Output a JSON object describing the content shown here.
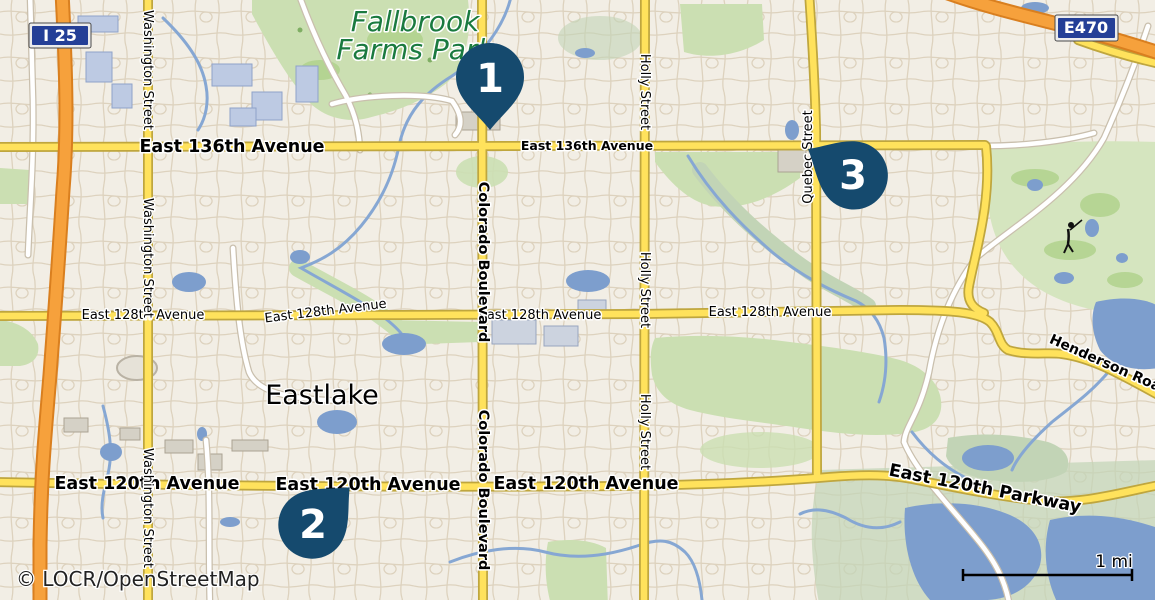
{
  "colors": {
    "bg": "#f2eee5",
    "marker": "#154a6e",
    "shield_blue": "#243f97",
    "road_yellow": "#ffe25c",
    "road_yellow_casing": "#bfa63e",
    "motorway": "#f6a13c",
    "motorway_casing": "#d97f1f",
    "white_road_casing": "#c9bfad",
    "water": "#7d9ecd",
    "stream": "#86a7d3",
    "park_green": "#cbdfb2",
    "golf_green": "#d5e5bf",
    "fairway": "#b0d28c",
    "wetland": "#c2d4b6",
    "label": "#000000",
    "park_label": "#1a7a3f",
    "halo": "#ffffff"
  },
  "shields": {
    "i25": "I 25",
    "e470": "E470"
  },
  "markers": [
    {
      "label": "1"
    },
    {
      "label": "2"
    },
    {
      "label": "3"
    }
  ],
  "labels": {
    "park_line1": "Fallbrook",
    "park_line2": "Farms Park",
    "town": "Eastlake",
    "e136_left": "East 136th Avenue",
    "e136_mid": "East 136th Avenue",
    "e128_a": "East 128th Avenue",
    "e128_b": "East 128th Avenue",
    "e128_c": "East 128th Avenue",
    "e128_d": "East 128th Avenue",
    "e120_a": "East 120th Avenue",
    "e120_b": "East 120th Avenue",
    "e120_c": "East 120th Avenue",
    "e120_parkway": "East 120th Parkway",
    "henderson": "Henderson Road",
    "washington": "Washington Street",
    "colorado": "Colorado Boulevard",
    "holly": "Holly Street",
    "quebec": "Quebec Street"
  },
  "scale": {
    "label": "1 mi"
  },
  "attribution": "© LOCR/OpenStreetMap"
}
